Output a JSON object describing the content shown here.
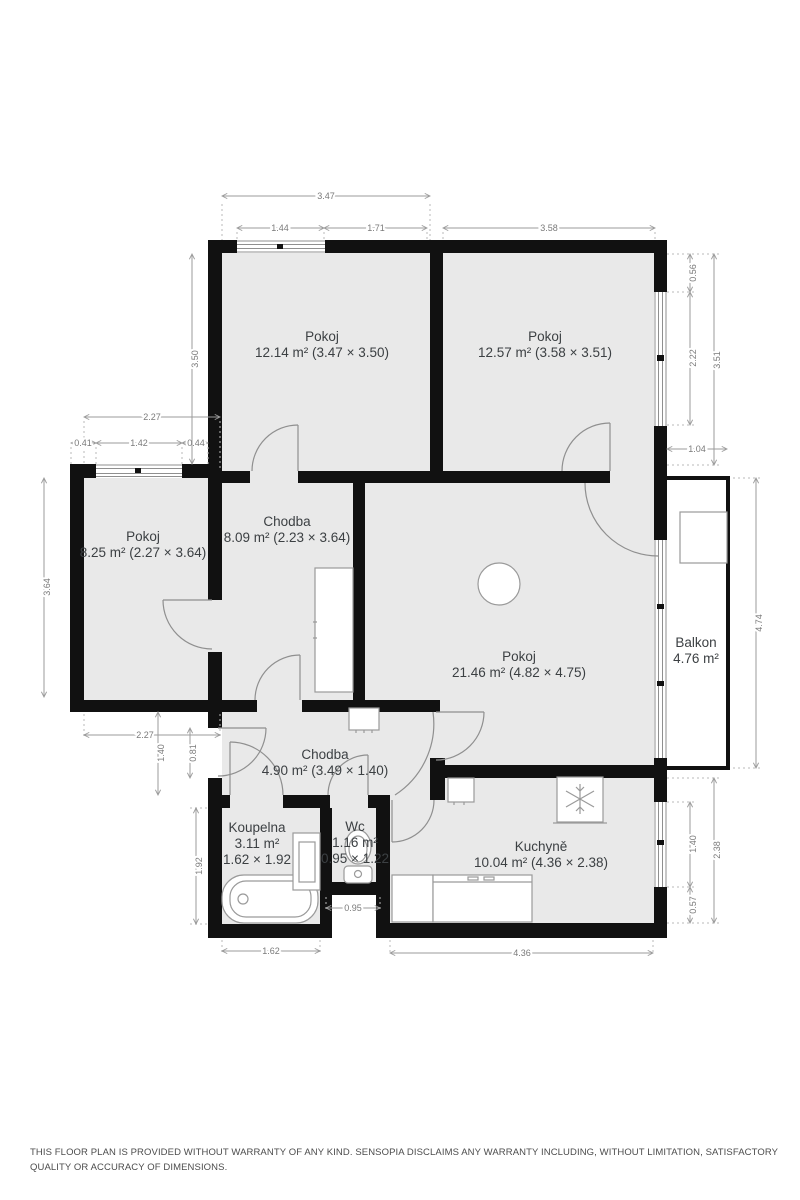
{
  "plan": {
    "rooms": {
      "pokoj_top_left": {
        "name": "Pokoj",
        "detail": "12.14 m² (3.47 × 3.50)"
      },
      "pokoj_top_right": {
        "name": "Pokoj",
        "detail": "12.57 m² (3.58 × 3.51)"
      },
      "pokoj_left": {
        "name": "Pokoj",
        "detail": "8.25 m² (2.27 × 3.64)"
      },
      "chodba_upper": {
        "name": "Chodba",
        "detail": "8.09 m² (2.23 × 3.64)"
      },
      "pokoj_main": {
        "name": "Pokoj",
        "detail": "21.46 m² (4.82 × 4.75)"
      },
      "balkon": {
        "name": "Balkon",
        "detail": "4.76 m²"
      },
      "chodba_lower": {
        "name": "Chodba",
        "detail": "4.90 m² (3.49 × 1.40)"
      },
      "koupelna": {
        "name": "Koupelna",
        "area": "3.11 m²",
        "dims": "1.62 × 1.92"
      },
      "wc": {
        "name": "Wc",
        "area": "1.16 m²",
        "dims": "0.95 × 1.22"
      },
      "kuchyne": {
        "name": "Kuchyně",
        "detail": "10.04 m² (4.36 × 2.38)"
      }
    },
    "measurements": {
      "m347": "3.47",
      "m144": "1.44",
      "m171": "1.71",
      "m358": "3.58",
      "m350": "3.50",
      "m227": "2.27",
      "m041": "0.41",
      "m142": "1.42",
      "m044": "0.44",
      "m364": "3.64",
      "m056": "0.56",
      "m222": "2.22",
      "m351": "3.51",
      "m104": "1.04",
      "m474": "4.74",
      "m140": "1.40",
      "m081": "0.81",
      "m192": "1.92",
      "m162": "1.62",
      "m095": "0.95",
      "m436": "4.36",
      "m057": "0.57",
      "m238": "2.38"
    },
    "colors": {
      "wall": "#111111",
      "floor": "#e9e9e9",
      "dimension": "#8a8a8a"
    }
  },
  "footer": {
    "disclaimer": "THIS FLOOR PLAN IS PROVIDED WITHOUT WARRANTY OF ANY KIND. SENSOPIA DISCLAIMS ANY WARRANTY INCLUDING, WITHOUT LIMITATION, SATISFACTORY QUALITY OR ACCURACY OF DIMENSIONS."
  }
}
